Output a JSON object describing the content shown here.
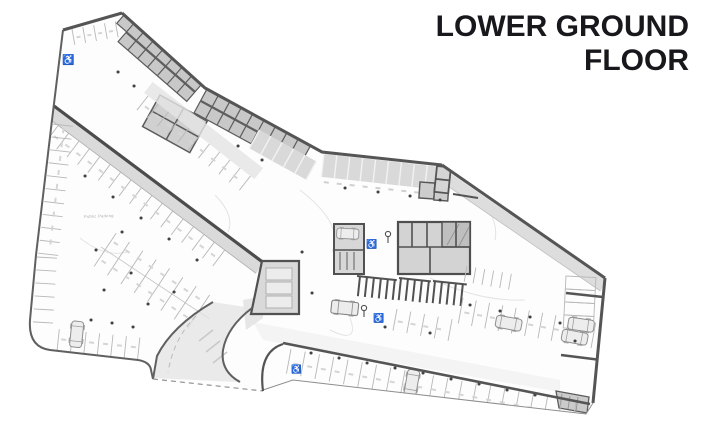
{
  "title": {
    "line1": "LOWER GROUND",
    "line2": "FLOOR",
    "color": "#17171c"
  },
  "plan": {
    "type": "parking-garage-floor-plan",
    "label_public_parking": "Public Parking",
    "accessible_symbol": "♿",
    "icons": {
      "accessible": "wheelchair-accessible-parking",
      "car": "parked-car",
      "van": "car-share-vehicle",
      "column": "structural-column-dot"
    },
    "colors": {
      "wall": "#4f4f4f",
      "room_fill": "#c6c6c6",
      "aisle_fill": "#dcdcdc",
      "stall_line": "#b5b5b5",
      "column_dot": "#3a3a3a",
      "title_text": "#17171c"
    }
  }
}
